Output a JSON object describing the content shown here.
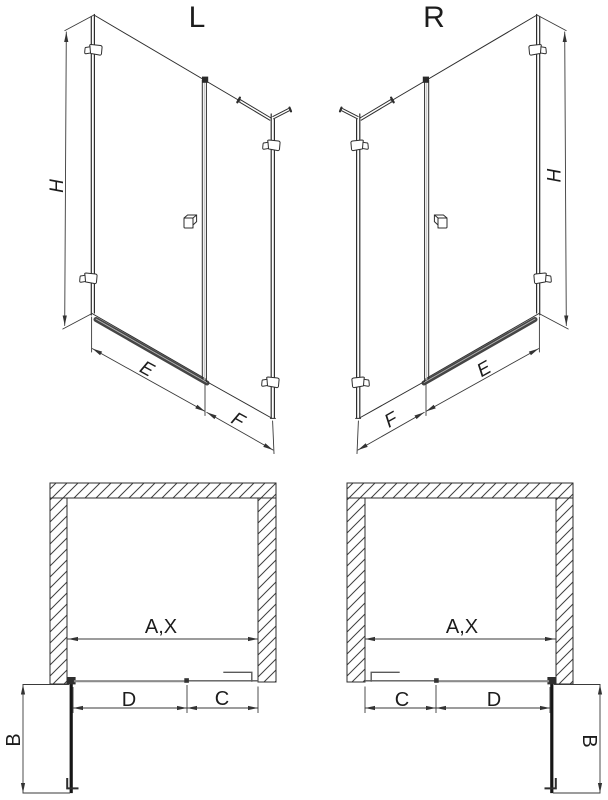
{
  "drawing": {
    "title": "shower enclosure technical drawing, L and R variants",
    "views": {
      "iso_left": {
        "variant_label": "L",
        "height_label": "H",
        "door_label": "E",
        "side_label": "F"
      },
      "iso_right": {
        "variant_label": "R",
        "height_label": "H",
        "door_label": "E",
        "side_label": "F"
      },
      "plan_left": {
        "width_label": "A,X",
        "door_label": "D",
        "fixed_label": "C",
        "depth_label": "B"
      },
      "plan_right": {
        "width_label": "A,X",
        "door_label": "D",
        "fixed_label": "C",
        "depth_label": "B"
      }
    },
    "colors": {
      "line": "#2e2e2e",
      "dimension": "#3a3a3a",
      "threshold": "#454545",
      "hatch": "#3f3f3f",
      "background": "#ffffff"
    }
  }
}
